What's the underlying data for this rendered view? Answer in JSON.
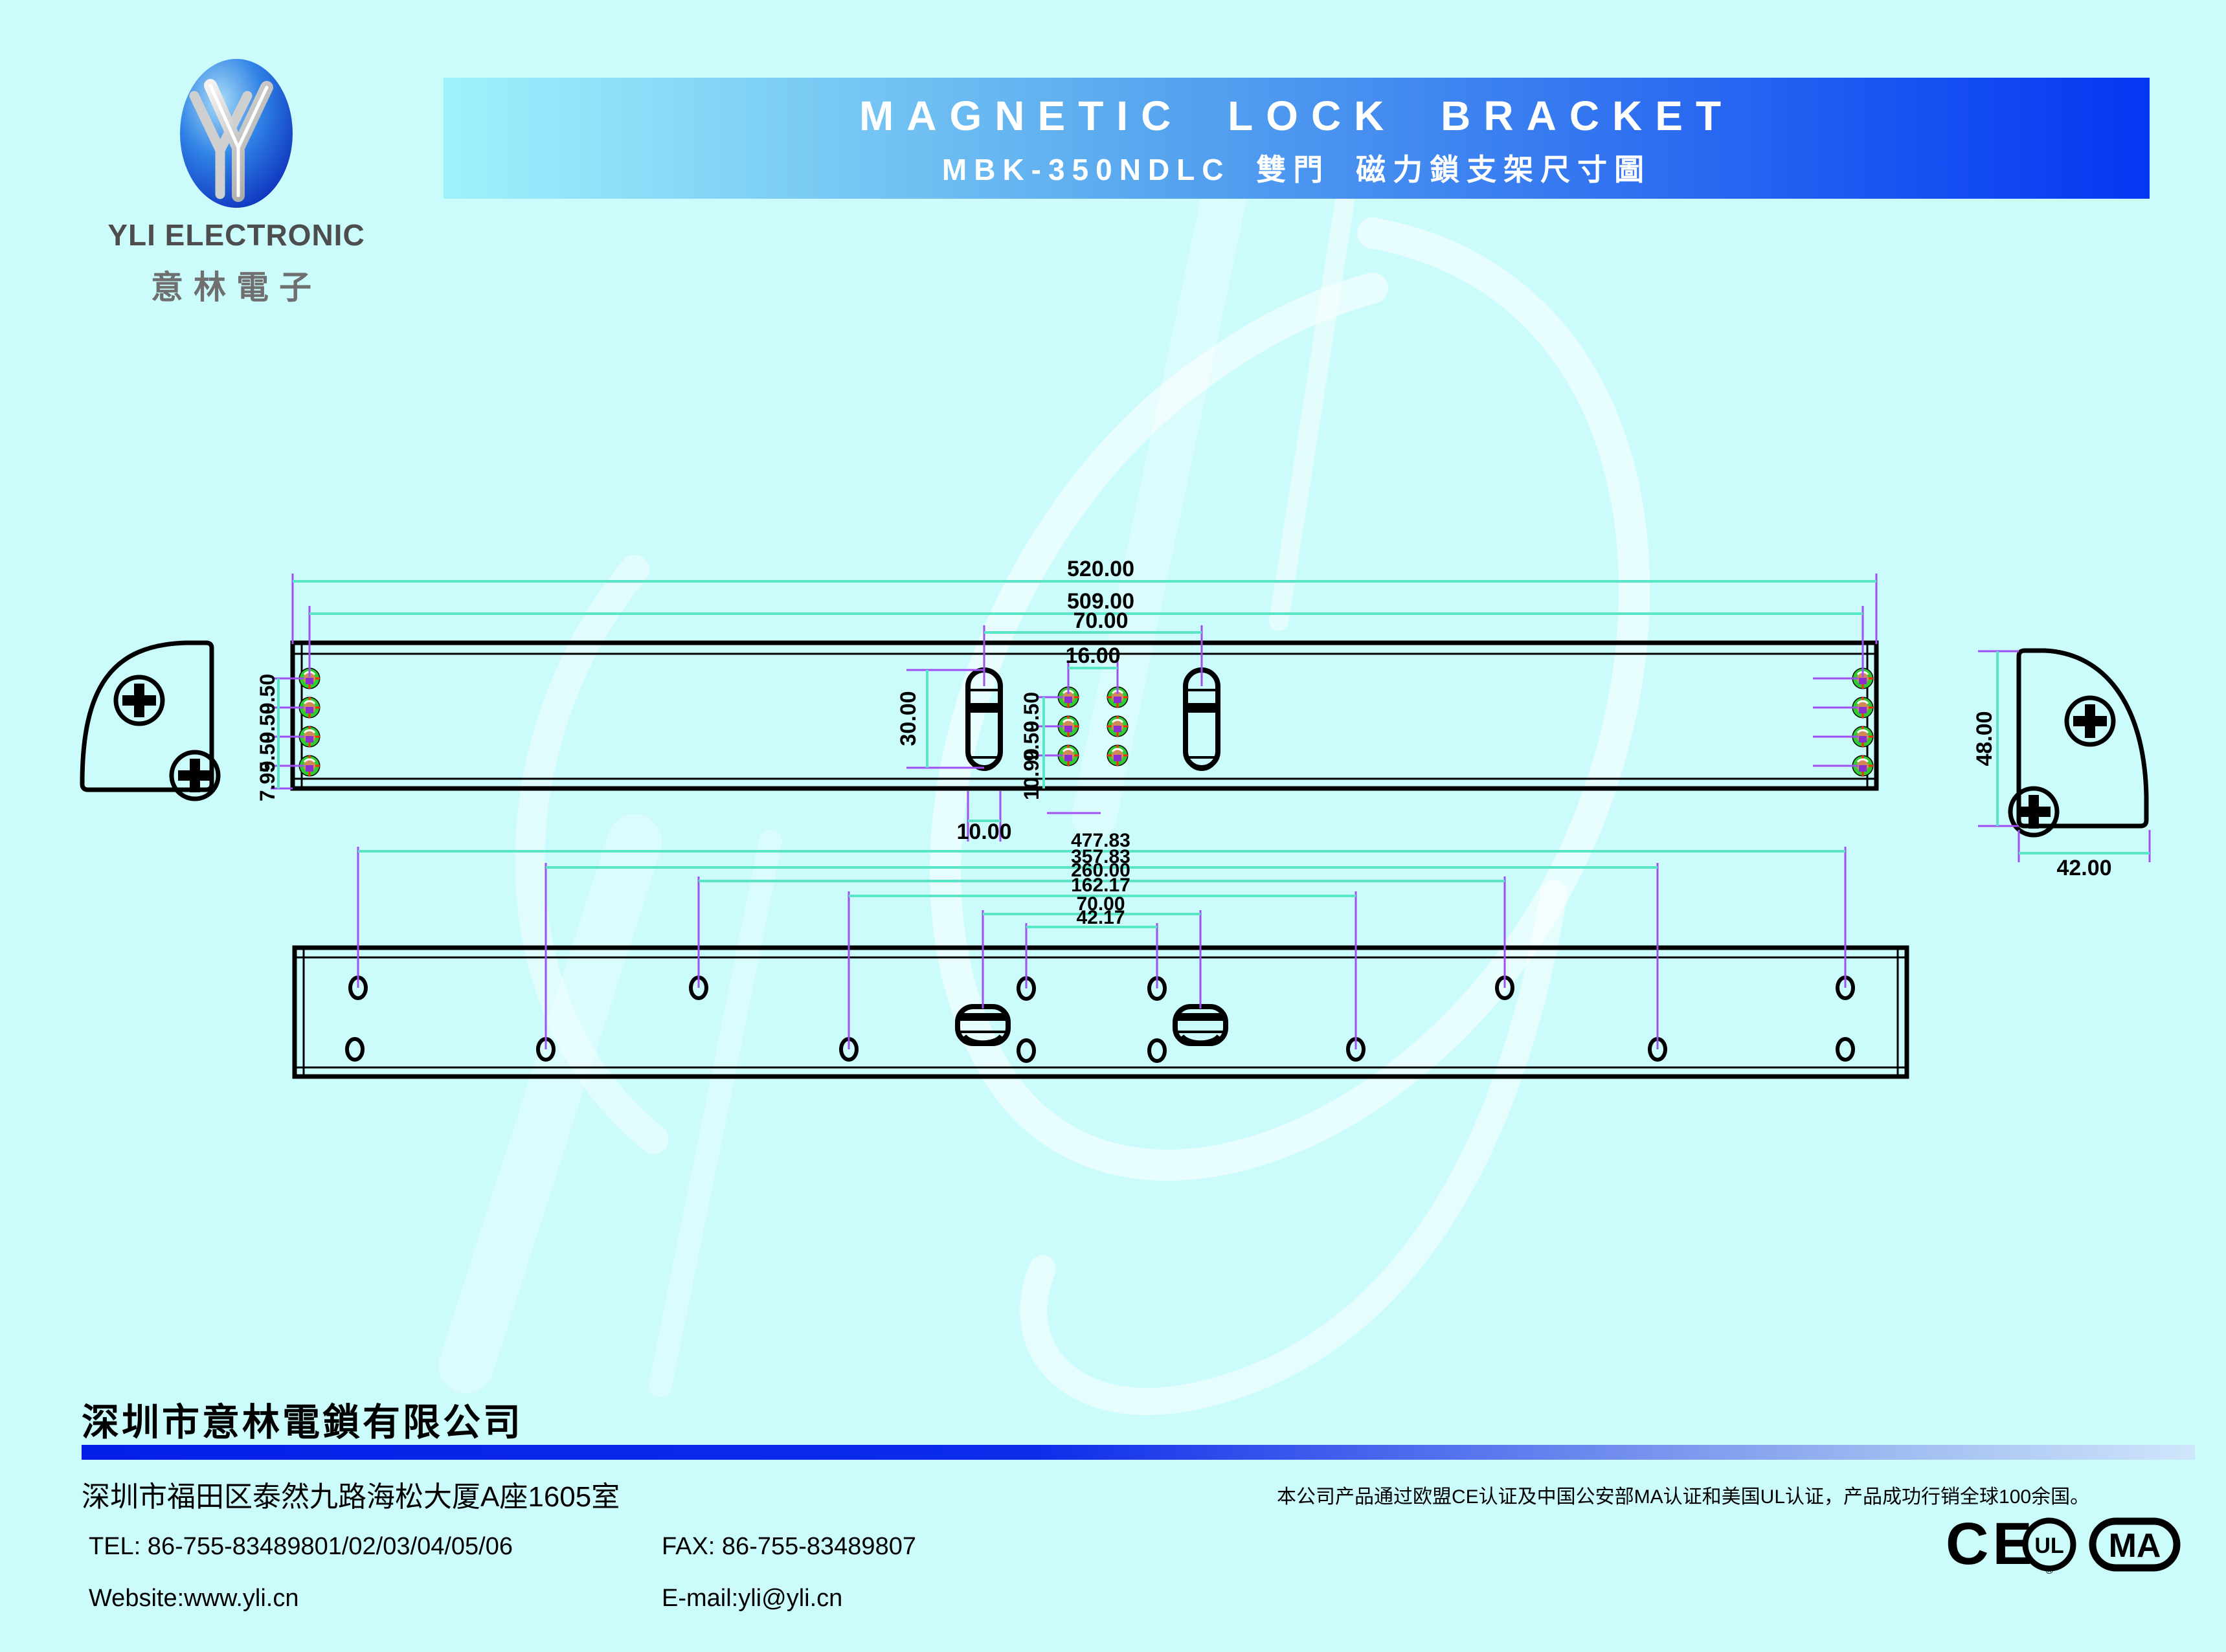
{
  "logo": {
    "name_en": "YLI ELECTRONIC",
    "name_cn": "意林電子"
  },
  "banner": {
    "title": "MAGNETIC LOCK BRACKET",
    "subtitle": "MBK-350NDLC 雙門 磁力鎖支架尺寸圖"
  },
  "drawing": {
    "top_view": {
      "overall_length": "520.00",
      "hole_span": "509.00",
      "slot_spacing": "70.00",
      "grid_width": "16.00",
      "slot_length": "30.00",
      "slot_width": "10.00",
      "edge_hole_pitch": [
        "9.50",
        "9.50",
        "9.50",
        "7.95"
      ],
      "grid_pitch": [
        "9.50",
        "9.50",
        "10.90"
      ],
      "endcap_height": "48.00",
      "endcap_width": "42.00"
    },
    "bottom_view": {
      "dim_477": "477.83",
      "dim_357": "357.83",
      "dim_260": "260.00",
      "dim_162": "162.17",
      "dim_70": "70.00",
      "dim_42": "42.17"
    }
  },
  "footer": {
    "company": "深圳市意林電鎖有限公司",
    "address": "深圳市福田区泰然九路海松大厦A座1605室",
    "tel": "TEL: 86-755-83489801/02/03/04/05/06",
    "fax": "FAX: 86-755-83489807",
    "website": "Website:www.yli.cn",
    "email": "E-mail:yli@yli.cn",
    "cert_note": "本公司产品通过欧盟CE认证及中国公安部MA认证和美国UL认证，产品成功行销全球100余国。",
    "marks": {
      "ce": "CE",
      "ul": "UL",
      "ul_r": "®",
      "ma": "MA"
    }
  },
  "colors": {
    "background": "#ccfbfc",
    "banner_start": "#9ff2fb",
    "banner_end": "#0437f2",
    "divider_blue": "#0420e8",
    "dim_line": "#58e6c6",
    "ext_line": "#a04ff0",
    "hole_ring_green": "#2ecc2e",
    "hole_fill_orange": "#cf8a56",
    "hole_center_purple": "#8c2fd0",
    "hole_tick_red": "#ff2a00"
  }
}
